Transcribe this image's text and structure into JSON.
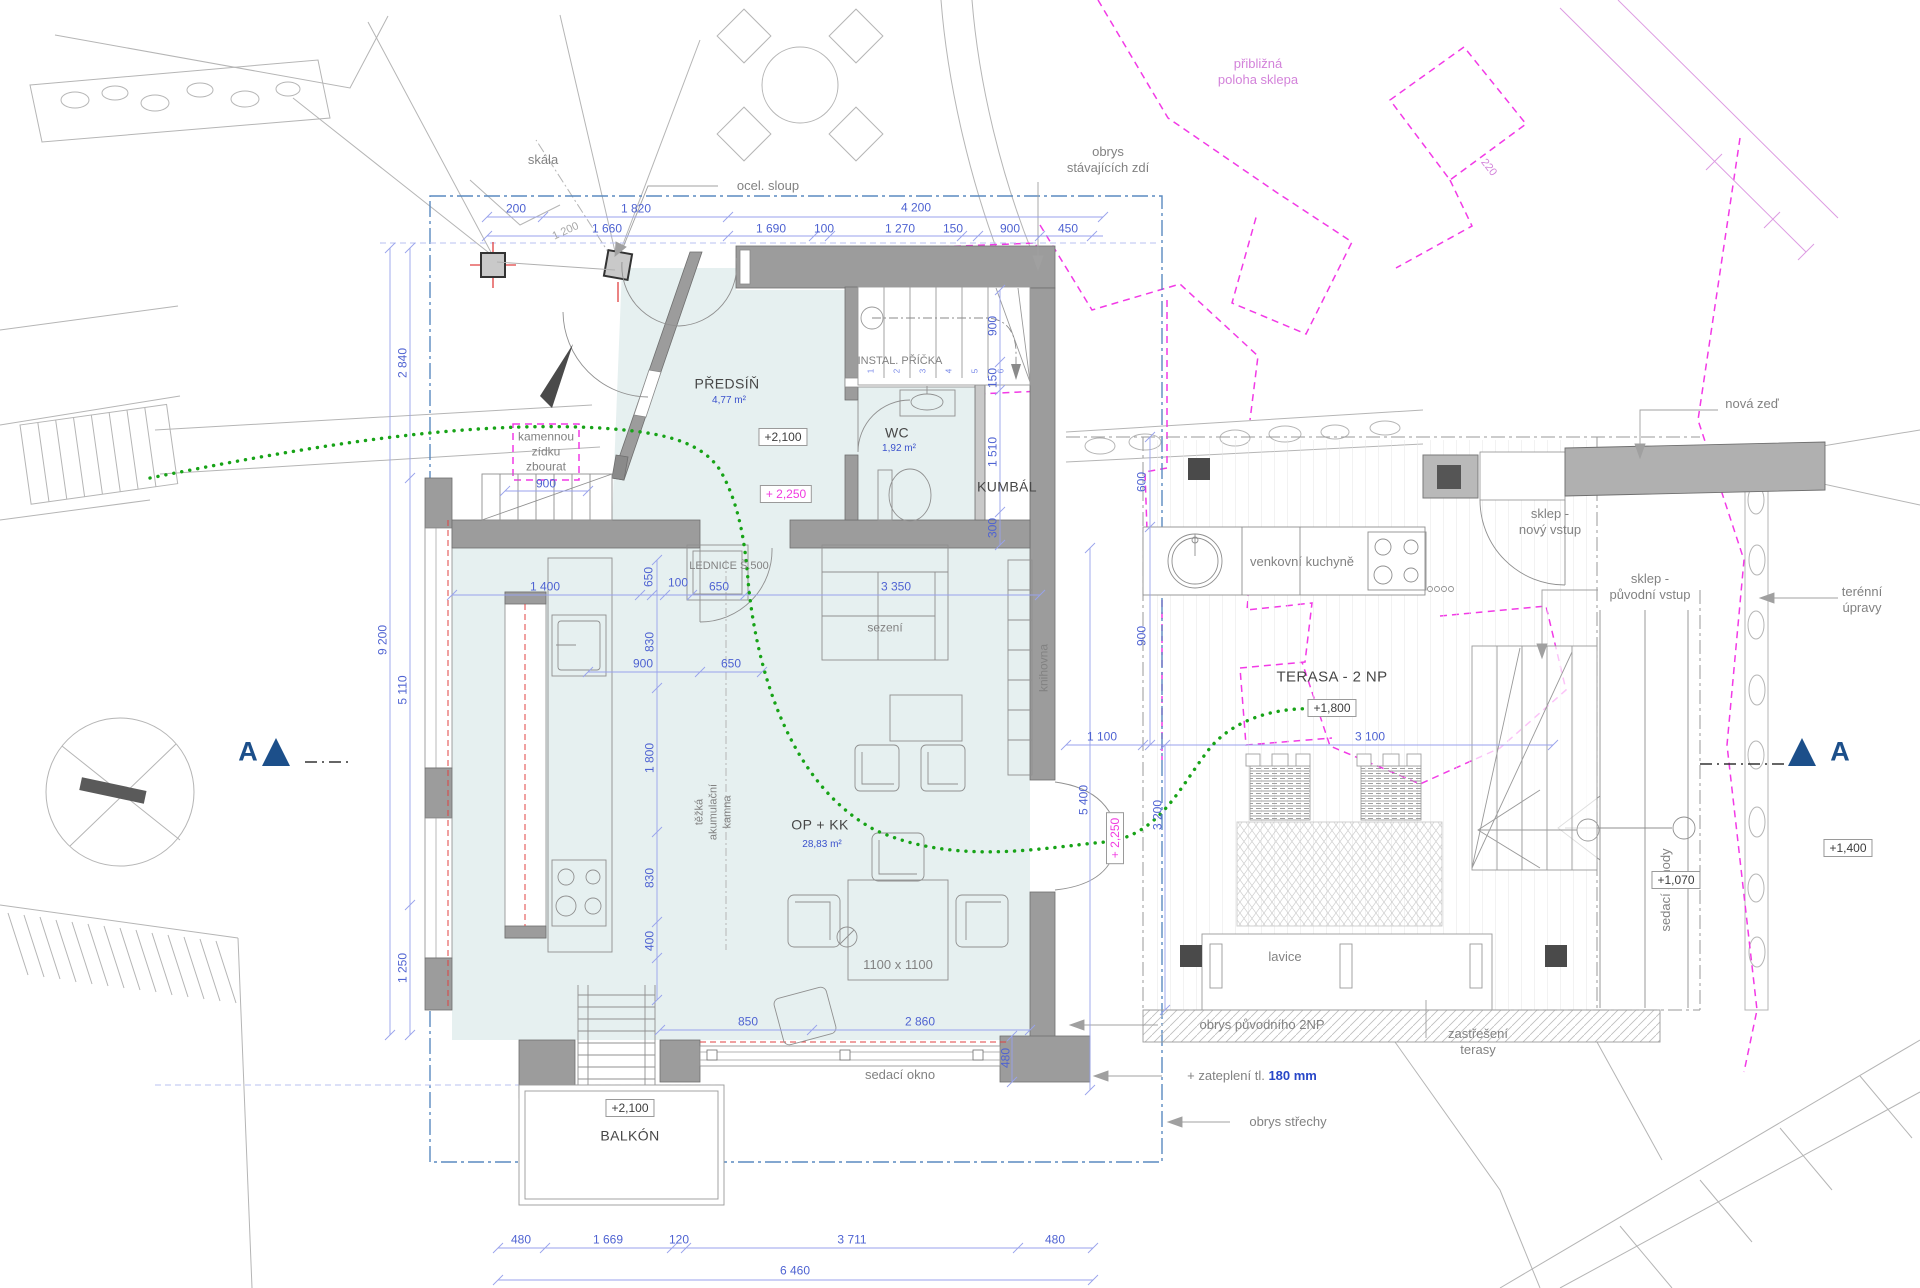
{
  "colors": {
    "dim_blue": "#4f63d2",
    "magenta": "#f03ae0",
    "violet": "#d383da",
    "green": "#17a317",
    "navy": "#1c4f8a",
    "wall": "#9c9c9c",
    "floor": "#e6f0f0"
  },
  "site": {
    "skala": "skála",
    "ocel_sloup": "ocel. sloup",
    "obrys_zdi": "obrys\nstávajících zdí",
    "pribl_sklep": "přibližná\npoloha sklepa",
    "nova_zed": "nová zeď",
    "terenni_upravy": "terénní\núpravy",
    "zidka": "kamennou\nzídku\nzbourat"
  },
  "house": {
    "predsin": "PŘEDSÍŇ",
    "predsin_area": "4,77 m²",
    "wc": "WC",
    "wc_area": "1,92 m²",
    "kumbal": "KUMBÁL",
    "op_kk": "OP + KK",
    "op_kk_area": "28,83 m²",
    "balkon": "BALKÓN",
    "instal": "INSTAL. PŘÍČKA",
    "lednice": "LEDNICE Š.500",
    "sezeni": "sezení",
    "knihovna": "knihovna",
    "kamna": "těžká\nakumulační\nkamna",
    "table": "1100 x 1100",
    "okno": "sedací okno",
    "stair_numbers": [
      "1",
      "2",
      "3",
      "4",
      "5",
      "6"
    ]
  },
  "terrace": {
    "name": "TERASA - 2 NP",
    "kuchyne": "venkovní kuchyně",
    "lavice": "lavice",
    "schody": "sedací schody",
    "sklep_novy": "sklep -\nnový vstup",
    "sklep_puv": "sklep -\npůvodní vstup"
  },
  "annotations": {
    "obrys_2np": "obrys původního 2NP",
    "zatepleni": "+ zateplení tl. ",
    "zatepleni_val": "180 mm",
    "obrys_strechy": "obrys střechy",
    "zastreseni": "zastřešení\nterasy"
  },
  "elevations": {
    "predsin": "+2,100",
    "vstup": "+ 2,250",
    "vstup2": "+ 2,250",
    "terasa": "+1,800",
    "schody": "+1,070",
    "zed": "+1,400",
    "balkon": "+2,100"
  },
  "section": {
    "label": "A"
  },
  "dims": {
    "top1": [
      "200",
      "1 820",
      "4 200"
    ],
    "top2": [
      "1 660",
      "1 690",
      "100",
      "1 270",
      "150",
      "900",
      "450"
    ],
    "diag": "1 200",
    "stairs": [
      "900",
      "150",
      "1 510",
      "300"
    ],
    "left": [
      "2 840",
      "9 200",
      "5 110",
      "1 250"
    ],
    "zidka": "900",
    "kitchen": [
      "1 400",
      "650",
      "100",
      "650",
      "3 350"
    ],
    "kitchen2": [
      "900",
      "650"
    ],
    "kitchen_v": [
      "830",
      "1 800",
      "830",
      "400"
    ],
    "living": "5 400",
    "window": [
      "850",
      "2 860",
      "480"
    ],
    "bottom": [
      "480",
      "1 669",
      "120",
      "3 711",
      "480"
    ],
    "total": "6 460",
    "gap": "1 100",
    "terasa_w": "3 100",
    "terasa_v": [
      "600",
      "900"
    ],
    "terasa_h": "3 200",
    "sklep": "220"
  }
}
